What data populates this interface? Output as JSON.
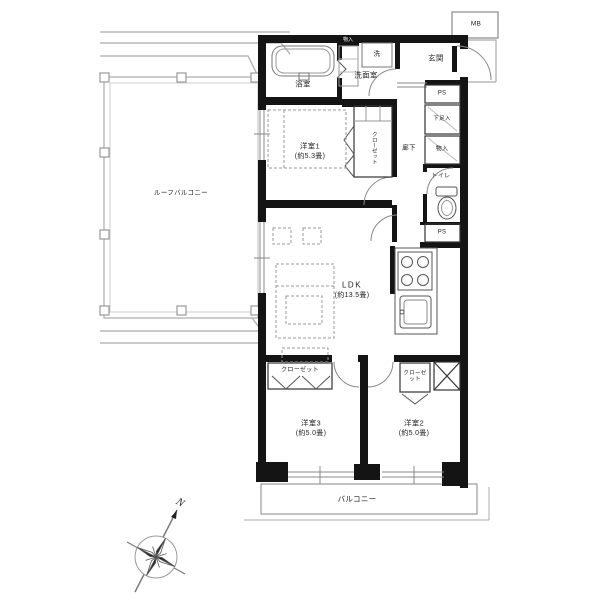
{
  "labels": {
    "roof_balcony": "ルーフバルコニー",
    "bathroom": "浴室",
    "laundry_cabinet": "物入",
    "washer": "洗",
    "washroom": "洗面室",
    "entrance": "玄関",
    "meter_box": "MB",
    "ps_top": "PS",
    "ps_bottom": "PS",
    "shoe_cabinet": "下足入",
    "hallway": "廊下",
    "storage": "物入",
    "toilet": "トイレ",
    "bedroom1_name": "洋室1",
    "bedroom1_size": "(約5.3畳)",
    "bedroom1_closet": "クローゼット",
    "ldk_name": "LDK",
    "ldk_size": "(約13.5畳)",
    "bedroom3_closet": "クローゼット",
    "bedroom3_name": "洋室3",
    "bedroom3_size": "(約5.0畳)",
    "bedroom2_name": "洋室2",
    "bedroom2_size": "(約5.0畳)",
    "bedroom2_closet": "クローゼット",
    "balcony": "バルコニー",
    "compass_north": "N"
  },
  "colors": {
    "wall": "#141414",
    "partition": "#333333",
    "fixture_line": "#555555",
    "light_line": "#9a9a9a",
    "railing": "#aaaaaa",
    "text": "#222222",
    "background": "#ffffff"
  }
}
